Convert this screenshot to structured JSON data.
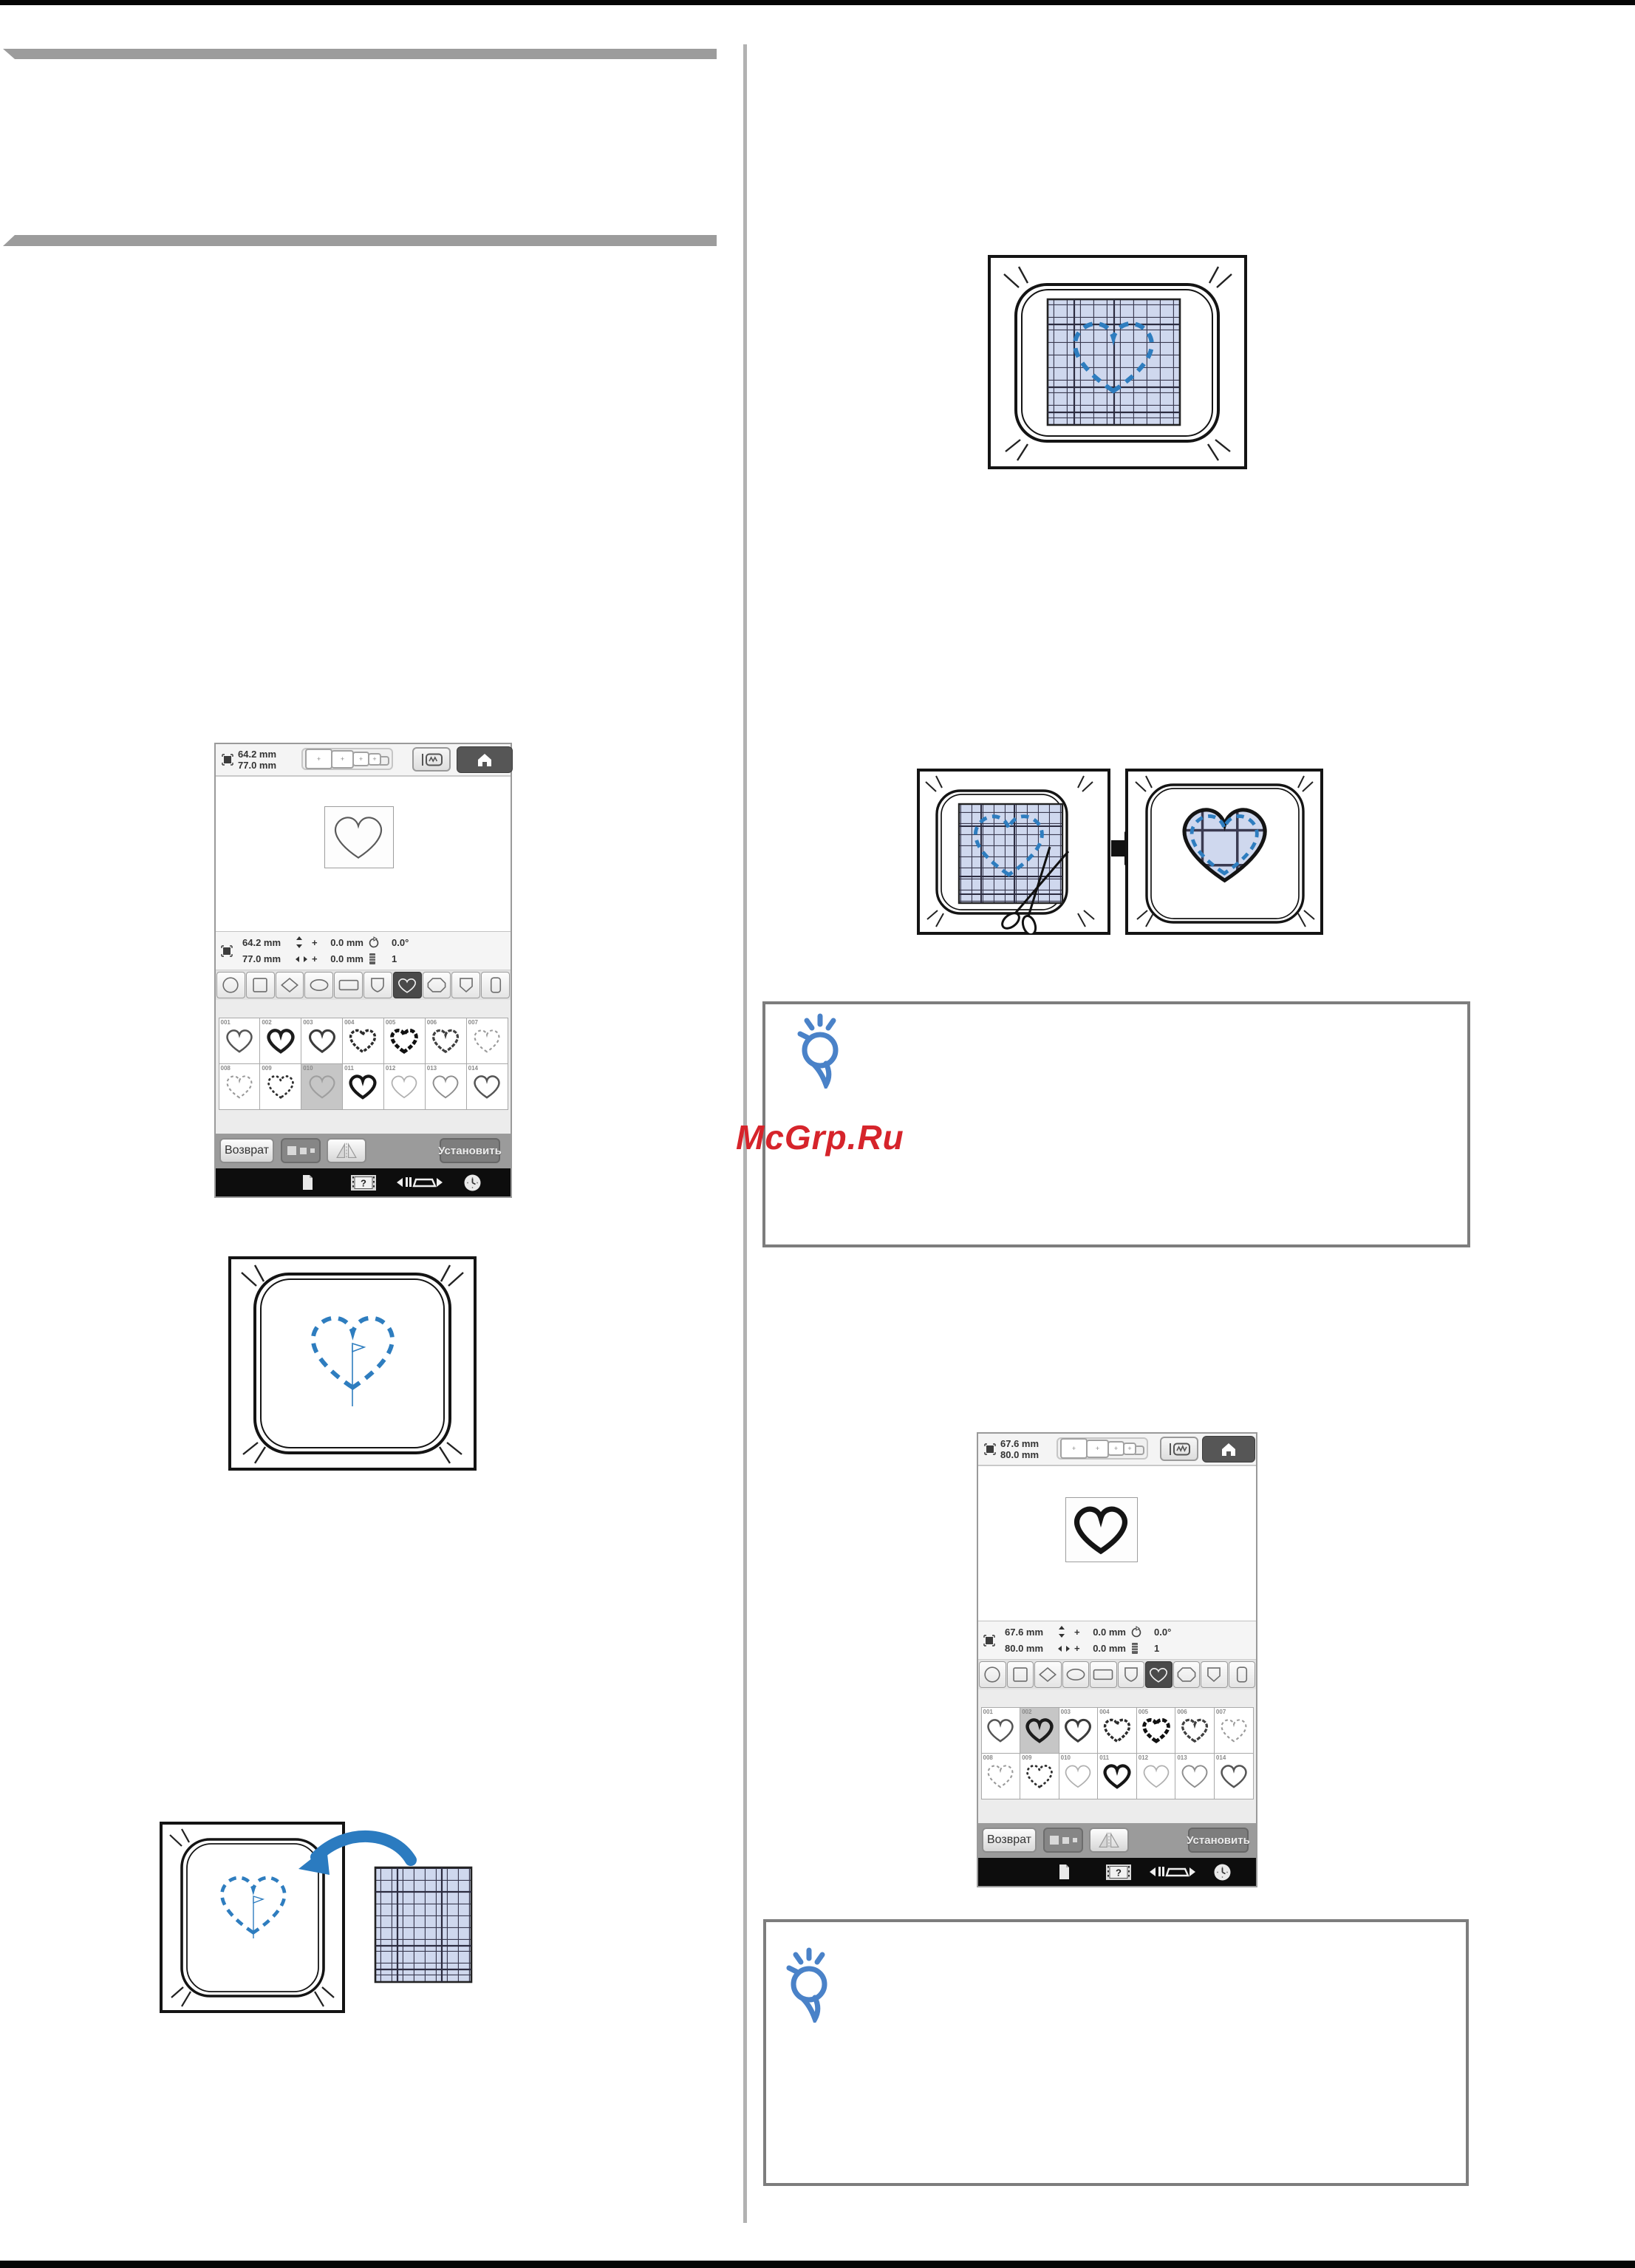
{
  "watermark": {
    "text": "McGrp.Ru",
    "color": "#d6242b"
  },
  "colors": {
    "accent_blue": "#2e7dbf",
    "arrow_blue": "#2b7bc0",
    "bulb_blue": "#4a82c8",
    "fabric": "#cfd8ee",
    "note_border": "#7d7d7d",
    "section_bar": "#9c9c9c"
  },
  "icons": {
    "home": "house",
    "frame_change": "embroidery-frame",
    "pattern_size": "frame-with-corners",
    "rotate": "rotate-circle",
    "thread": "spool",
    "document": "page",
    "help": "film-question",
    "presser_foot": "foot-with-arrows",
    "clock": "clock-face",
    "hint": "lightbulb-bubble"
  },
  "screen1": {
    "header": {
      "width": "64.2 mm",
      "height": "77.0 mm"
    },
    "status": {
      "width": "64.2 mm",
      "height": "77.0 mm",
      "plus_v": "+",
      "plus_h": "+",
      "dy": "0.0 mm",
      "dx": "0.0 mm",
      "angle": "0.0°",
      "count": "1"
    },
    "shapes": {
      "selected_index": 6,
      "items": [
        "circle",
        "square",
        "diamond",
        "ellipse",
        "rectangle",
        "shield",
        "heart",
        "octagon",
        "badge",
        "roundrect"
      ]
    },
    "patterns": {
      "selected": "010",
      "items": [
        {
          "id": "001",
          "style": "medium"
        },
        {
          "id": "002",
          "style": "bold"
        },
        {
          "id": "003",
          "style": "mediumdark"
        },
        {
          "id": "004",
          "style": "dotline"
        },
        {
          "id": "005",
          "style": "boldscallop"
        },
        {
          "id": "006",
          "style": "scallopmed"
        },
        {
          "id": "007",
          "style": "dashlight"
        },
        {
          "id": "008",
          "style": "dashlight"
        },
        {
          "id": "009",
          "style": "scallop"
        },
        {
          "id": "010",
          "style": "plain"
        },
        {
          "id": "011",
          "style": "boldsolid"
        },
        {
          "id": "012",
          "style": "thinlight"
        },
        {
          "id": "013",
          "style": "thin"
        },
        {
          "id": "014",
          "style": "medium"
        }
      ]
    },
    "toolbar": {
      "return": "Возврат",
      "set": "Установить"
    }
  },
  "screen2": {
    "header": {
      "width": "67.6 mm",
      "height": "80.0 mm"
    },
    "status": {
      "width": "67.6 mm",
      "height": "80.0 mm",
      "plus_v": "+",
      "plus_h": "+",
      "dy": "0.0 mm",
      "dx": "0.0 mm",
      "angle": "0.0°",
      "count": "1"
    },
    "shapes": {
      "selected_index": 6,
      "items": [
        "circle",
        "square",
        "diamond",
        "ellipse",
        "rectangle",
        "shield",
        "heart",
        "octagon",
        "badge",
        "roundrect"
      ]
    },
    "patterns": {
      "selected": "002",
      "items": [
        {
          "id": "001",
          "style": "medium"
        },
        {
          "id": "002",
          "style": "bold"
        },
        {
          "id": "003",
          "style": "mediumdark"
        },
        {
          "id": "004",
          "style": "dotline"
        },
        {
          "id": "005",
          "style": "boldscallop"
        },
        {
          "id": "006",
          "style": "scallopmed"
        },
        {
          "id": "007",
          "style": "dashlight"
        },
        {
          "id": "008",
          "style": "dashlight"
        },
        {
          "id": "009",
          "style": "scallop"
        },
        {
          "id": "010",
          "style": "thinlight"
        },
        {
          "id": "011",
          "style": "boldsolid"
        },
        {
          "id": "012",
          "style": "thinlight"
        },
        {
          "id": "013",
          "style": "thin"
        },
        {
          "id": "014",
          "style": "medium"
        }
      ]
    },
    "toolbar": {
      "return": "Возврат",
      "set": "Установить"
    }
  }
}
